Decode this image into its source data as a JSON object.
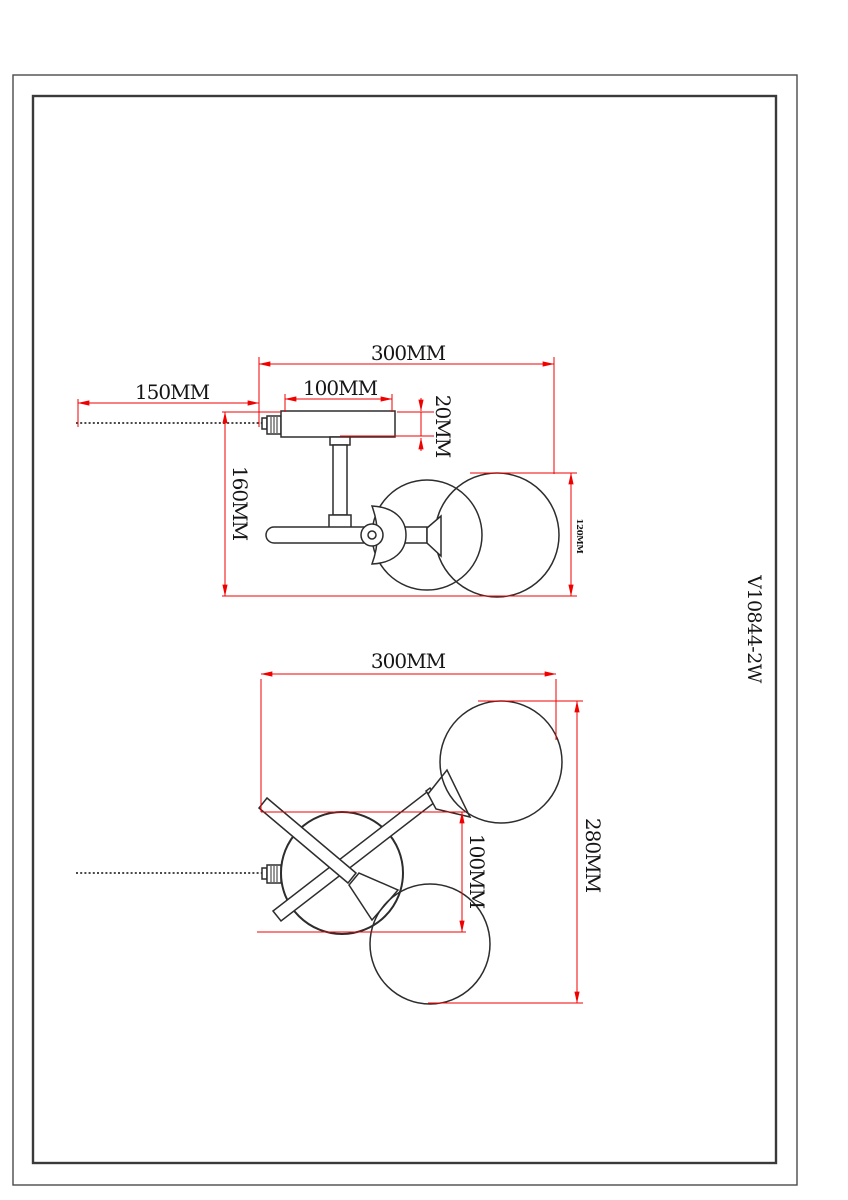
{
  "sheet": {
    "background": "#ffffff",
    "border_color": "#3a3a3a",
    "product_code": "V10844-2W"
  },
  "colors": {
    "dimension_red": "#f10000",
    "drawing_black": "#2d2d2d"
  },
  "side_view": {
    "dims": {
      "overall_width": "300MM",
      "chain_length": "150MM",
      "canopy_width": "100MM",
      "canopy_thickness": "20MM",
      "overall_height": "160MM",
      "shade_diameter": "120MM"
    }
  },
  "bottom_view": {
    "dims": {
      "overall_width": "300MM",
      "canopy_diameter": "100MM",
      "overall_depth": "280MM"
    }
  }
}
